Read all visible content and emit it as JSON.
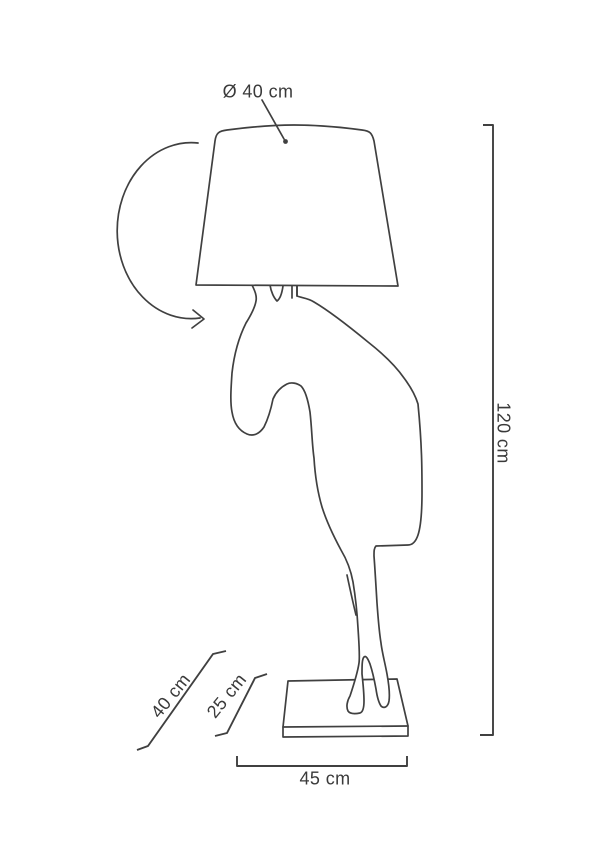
{
  "colors": {
    "background": "#ffffff",
    "line": "#404040",
    "text": "#3a3a3a"
  },
  "diagram": {
    "kind": "product-dimension-drawing",
    "shapes": [
      "rotation-arrow",
      "lampshade",
      "horse-silhouette",
      "base-plate"
    ],
    "dimensions": {
      "shade_diameter": {
        "label": "Ø 40 cm",
        "value": 40,
        "unit": "cm"
      },
      "total_height": {
        "label": "120 cm",
        "value": 120,
        "unit": "cm"
      },
      "base_width": {
        "label": "45 cm",
        "value": 45,
        "unit": "cm"
      },
      "depth_outer": {
        "label": "40 cm",
        "value": 40,
        "unit": "cm"
      },
      "depth_inner": {
        "label": "25 cm",
        "value": 25,
        "unit": "cm"
      }
    }
  }
}
